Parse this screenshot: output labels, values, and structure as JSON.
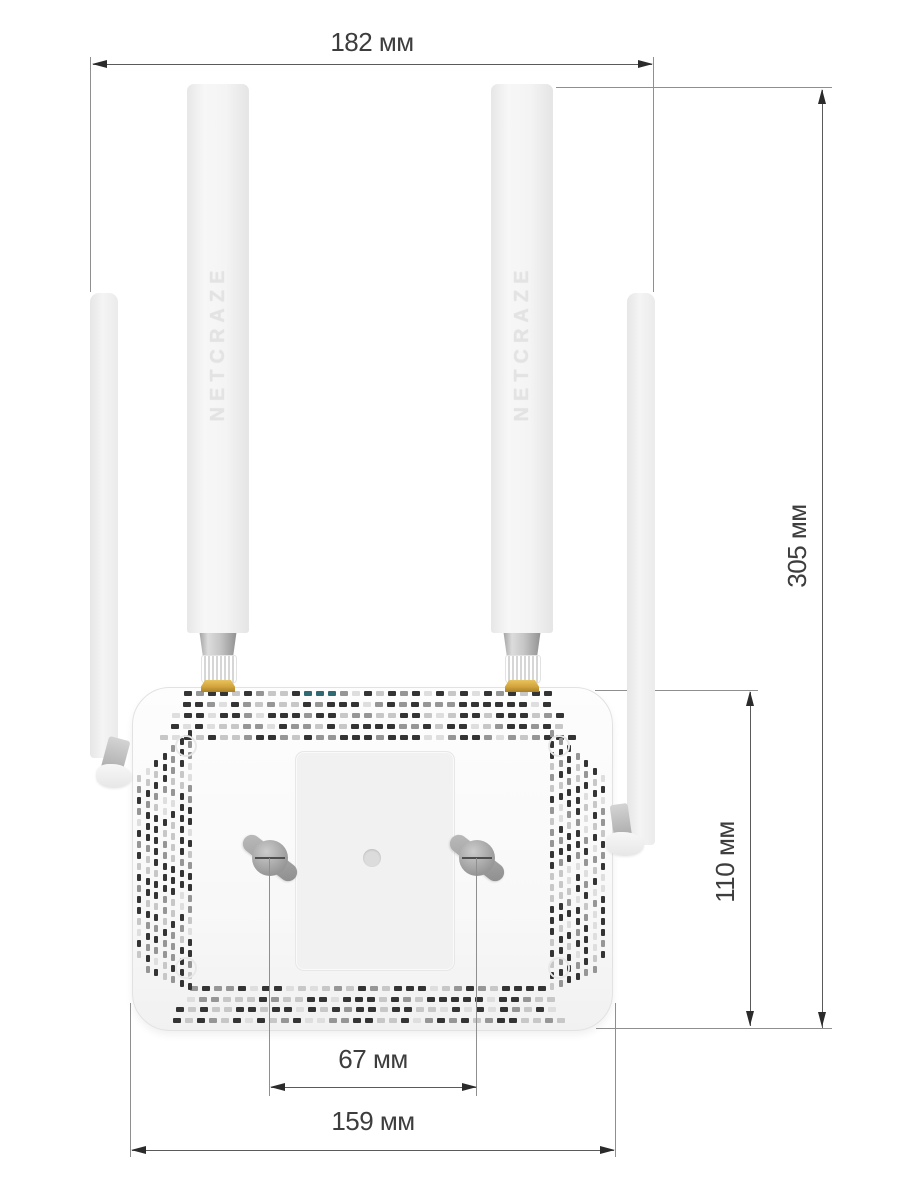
{
  "product": {
    "brand": "NETCRAZE"
  },
  "dimensions": {
    "overall_width": {
      "label": "182 мм",
      "value_mm": 182
    },
    "overall_height": {
      "label": "305 мм",
      "value_mm": 305
    },
    "body_height": {
      "label": "110 мм",
      "value_mm": 110
    },
    "mount_spacing": {
      "label": "67 мм",
      "value_mm": 67
    },
    "body_width": {
      "label": "159 мм",
      "value_mm": 159
    }
  },
  "colors": {
    "background": "#ffffff",
    "dimension_line": "#5a5a5a",
    "dimension_extension": "#8f8f8f",
    "dimension_arrow": "#2b2b2b",
    "dimension_text": "#3d3d3d",
    "body": "#fafafa",
    "antenna": "#f3f3f3",
    "brand_text": "#e3e3e3",
    "connector_gold": "#d2a53e",
    "mount_slot": "#9a9a9a",
    "vent_dark": "#343434",
    "vent_mid": "#969696",
    "vent_light": "#c7c7c7",
    "vent_faint": "#dedede",
    "vent_teal": "#2f6a72"
  }
}
